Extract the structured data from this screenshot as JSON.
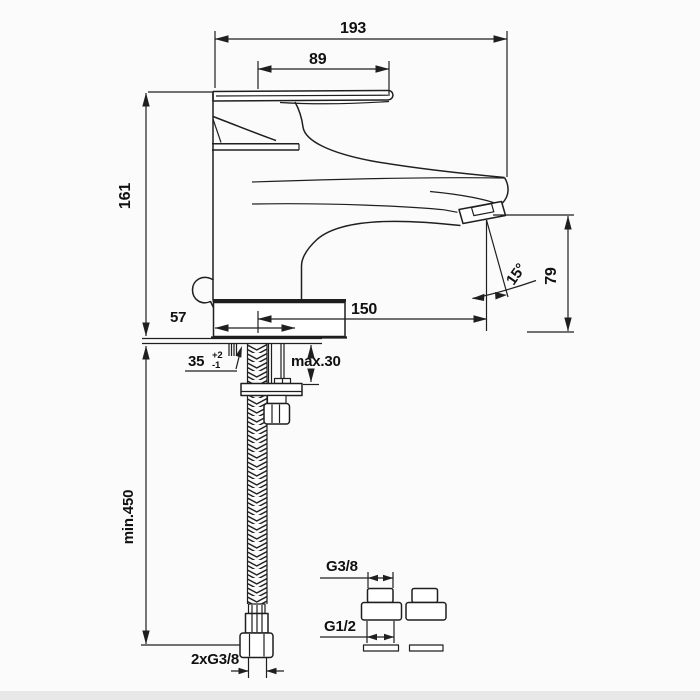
{
  "drawing": {
    "title_hint": "faucet-technical-dimension-drawing",
    "background": "#fbfbfb",
    "line_color": "#1f1f1f",
    "text_color": "#111111",
    "dimensions": {
      "total_width": "193",
      "handle_length": "89",
      "overall_height": "161",
      "spout_reach": "150",
      "base_depth": "57",
      "deck_thickness": "35",
      "deck_thickness_tol_plus": "+2",
      "deck_thickness_tol_minus": "-1",
      "deck_max_thickness": "max.30",
      "spout_angle": "15°",
      "outlet_height": "79",
      "hose_min_length": "min.450",
      "hose_connections": "2xG3/8",
      "adapter_top_thread": "G3/8",
      "adapter_bottom_thread": "G1/2"
    }
  }
}
